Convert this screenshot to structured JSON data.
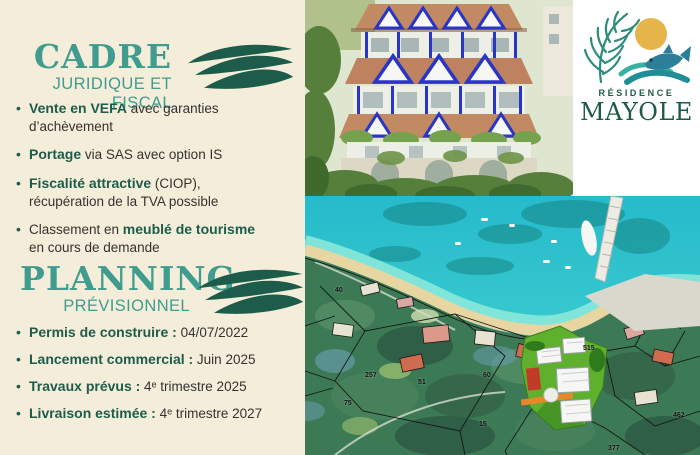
{
  "brand": {
    "residence_label": "RÉSIDENCE",
    "name": "MAYOLE"
  },
  "colors": {
    "background_cream": "#f4edda",
    "heading_teal": "#3f9c8e",
    "brand_dark_green": "#1d5c4b",
    "body_text": "#33322e",
    "render_accent_blue": "#2835c5",
    "map_water": "#2ec3cc",
    "map_site_green": "#5fb02c",
    "logo_sun_gold": "#e5b54a"
  },
  "sections": {
    "cadre": {
      "title": "CADRE",
      "subtitle": "JURIDIQUE ET FISCAL",
      "bullet_glyph": "•",
      "bullets": [
        {
          "s1": "Vente en VEFA",
          "s2": " avec garanties d’achèvement"
        },
        {
          "s1": "Portage",
          "s2": " via SAS avec option IS"
        },
        {
          "s1": "Fiscalité attractive",
          "s2": " (CIOP),",
          "line2": "récupération de la TVA possible"
        },
        {
          "s0": "Classement en ",
          "s1": "meublé de tourisme",
          "line2": "en cours de demande"
        }
      ]
    },
    "planning": {
      "title": "PLANNING",
      "subtitle": "PRÉVISIONNEL",
      "bullet_glyph": "•",
      "bullets": [
        {
          "s1": "Permis de construire :",
          "s2": " 04/07/2022"
        },
        {
          "s1": "Lancement commercial :",
          "s2": " Juin 2025"
        },
        {
          "s1": "Travaux prévus :",
          "s2": " 4ᵉ trimestre 2025"
        },
        {
          "s1": "Livraison estimée :",
          "s2": " 4ᵉ trimestre 2027"
        }
      ]
    }
  },
  "map": {
    "parcels": [
      "257",
      "51",
      "60",
      "75",
      "15",
      "515",
      "377",
      "462",
      "40"
    ]
  }
}
